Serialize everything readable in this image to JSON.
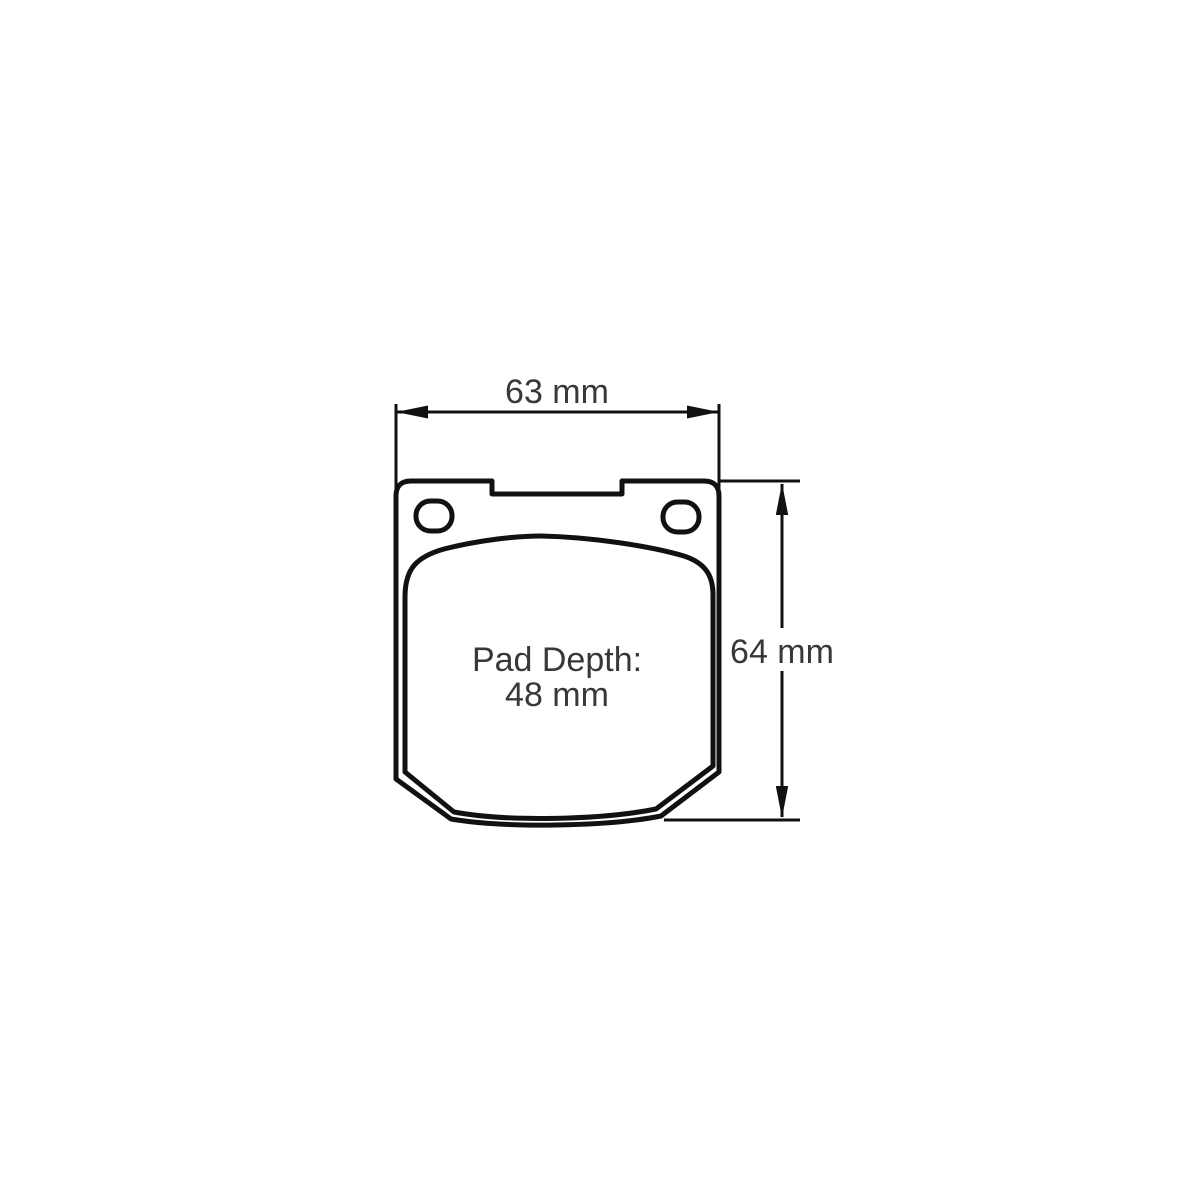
{
  "drawing": {
    "labels": {
      "width": "63 mm",
      "height": "64 mm",
      "pad_depth_caption": "Pad Depth:",
      "pad_depth_value": "48 mm"
    },
    "colors": {
      "line": "#111111",
      "text": "#383838",
      "background": "#ffffff"
    }
  }
}
